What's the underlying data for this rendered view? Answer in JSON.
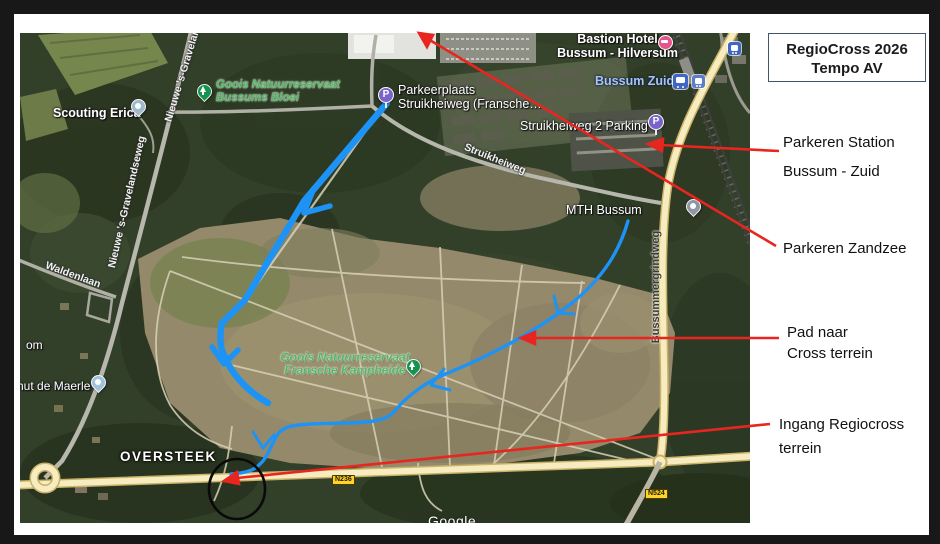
{
  "slide": {
    "title_box": {
      "line1": "RegioCross 2026",
      "line2": "Tempo AV"
    },
    "annotations": [
      {
        "lines": [
          "Parkeren Station",
          "Bussum - Zuid"
        ]
      },
      {
        "lines": [
          "Parkeren Zandzee"
        ]
      },
      {
        "lines": [
          "Pad naar",
          "Cross terrein"
        ]
      },
      {
        "lines": [
          "Ingang Regiocross",
          "terrein"
        ]
      }
    ]
  },
  "map": {
    "route_note": "OVERSTEEK",
    "attribution": "Google",
    "shields": {
      "n236": "N236",
      "n524": "N524"
    },
    "icons": {
      "parking_glyph": "P"
    },
    "places": {
      "scouting_erica": "Scouting Erica",
      "goois_bussums_line1": "Goois Natuurreservaat",
      "goois_bussums_line2": "Bussums Bloei",
      "parkeerplaats_line1": "Parkeerplaats",
      "parkeerplaats_line2": "Struikheiweg (Fransche…",
      "bastion_line1": "Bastion Hotel",
      "bastion_line2": "Bussum - Hilversum",
      "bussum_zuid": "Bussum Zuid",
      "struikheiweg2_parking": "Struikheiweg 2 Parking",
      "mth_bussum": "MTH Bussum",
      "goois_fransche_line1": "Goois Natuurreservaat",
      "goois_fransche_line2": "Fransche Kampheide",
      "hut_de_maerle": "hut de Maerle",
      "om": "om"
    },
    "roads": {
      "struikheiweg": "Struikheiweg",
      "bussummergrindweg": "Bussummergrindweg",
      "waldenlaan": "Waldenlaan",
      "nieuwe_top": "Nieuwe 's-Gravelandseweg",
      "nieuwe_mid": "Nieuwe 's-Gravelandseweg"
    },
    "colors": {
      "route_blue": "#1d93f5",
      "annotation_red": "#e8251f",
      "shield_yellow": "#ffd429"
    }
  }
}
